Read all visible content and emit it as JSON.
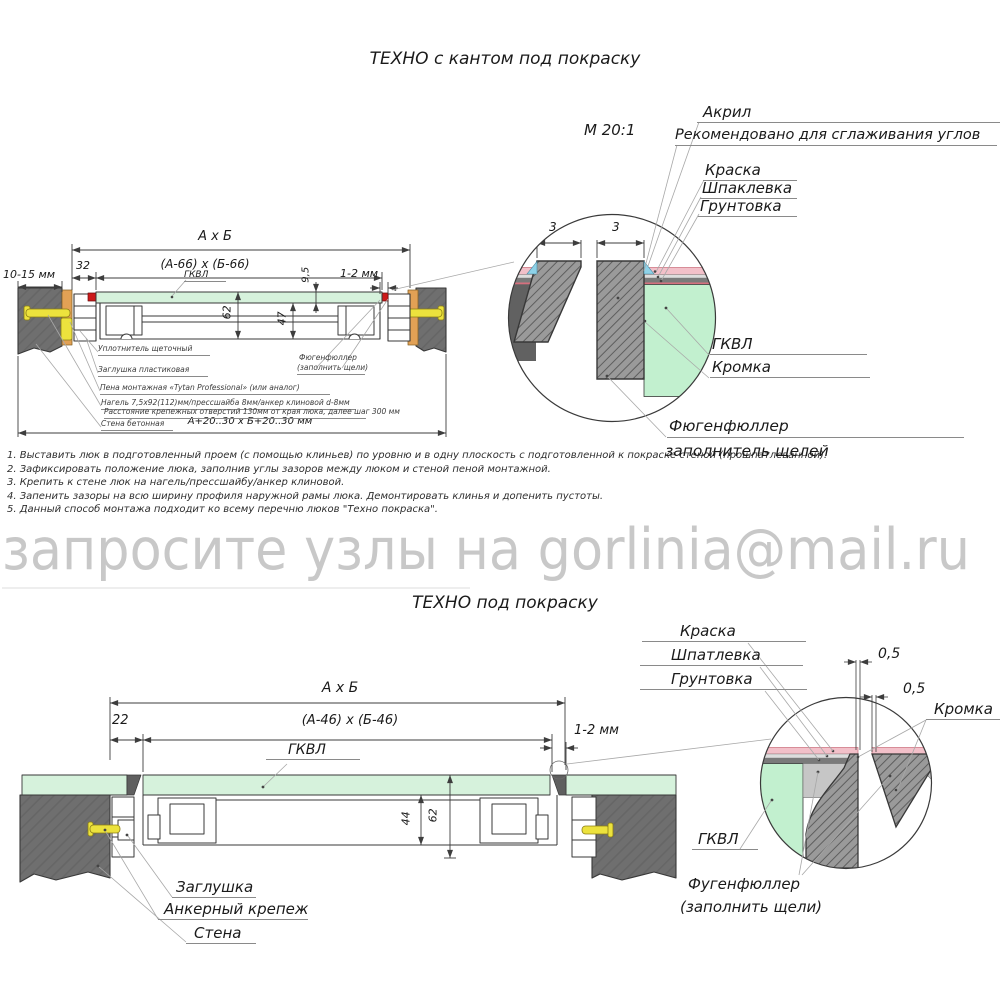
{
  "colors": {
    "wall_gray": "#6f6f6f",
    "panel_green": "#d6f2dc",
    "detail_green": "#c2f0cf",
    "wedge_orange": "#e2a155",
    "anchor_yellow": "#ece23d",
    "marker_red": "#cc1a1a",
    "paint_pink": "#f2c0c9",
    "acrylic_blue": "#8ed2e8",
    "filler_gray": "#c6c6c6",
    "watermark_gray": "#c8c8c8"
  },
  "watermark": {
    "text": "запросите узлы на gorlinia@mail.ru"
  },
  "top": {
    "title": "ТЕХНО с кантом под покраску",
    "scale": "М 20:1",
    "dims": {
      "axb": "А х Б",
      "inner": "(А-66) х (Б-66)",
      "d32": "32",
      "d1015": "10-15 мм",
      "d95": "9,5",
      "d12": "1-2 мм",
      "d62": "62",
      "d47": "47",
      "opening": "А+20..30 х Б+20..30 мм",
      "d3l": "3",
      "d3r": "3"
    },
    "labels": {
      "gkvl_panel": "ГКВЛ",
      "acryl": "Акрил",
      "acryl_note": "Рекомендовано для сглаживания углов",
      "paint": "Краска",
      "putty": "Шпаклевка",
      "primer": "Грунтовка",
      "gkvl": "ГКВЛ",
      "edge": "Кромка",
      "filler_1": "Фюгенфюллер",
      "filler_2": "заполнитель щелей"
    },
    "callouts": {
      "seal": "Уплотнитель щеточный",
      "plug": "Заглушка пластиковая",
      "foam": "Пена монтажная «Tytan Professional» (или аналог)",
      "nagel": "Нагель 7,5х92(112)мм/прессшайба 8мм/анкер клиновой d-8мм",
      "spacing": "Расстояние крепежных отверстий 130мм от края люка, далее шаг 300 мм",
      "wall": "Стена бетонная",
      "filler_1": "Фюгенфюллер",
      "filler_2": "(заполнить щели)"
    },
    "notes": [
      "1. Выставить люк в подготовленный проем (с помощью клиньев) по уровню и в одну плоскость с подготовленной к покраске стеной (прошпатлеванной).",
      "2. Зафиксировать положение люка, заполнив углы зазоров между люком и стеной пеной монтажной.",
      "3. Крепить к стене люк на нагель/прессшайбу/анкер клиновой.",
      "4. Запенить зазоры на всю ширину профиля наружной рамы люка. Демонтировать клинья и допенить пустоты.",
      "5. Данный способ монтажа подходит ко всему перечню люков \"Техно покраска\"."
    ]
  },
  "bottom": {
    "title": "ТЕХНО под покраску",
    "dims": {
      "axb": "А х Б",
      "inner": "(А-46) х (Б-46)",
      "d22": "22",
      "d12": "1-2 мм",
      "d44": "44",
      "d62": "62",
      "d05a": "0,5",
      "d05b": "0,5"
    },
    "labels": {
      "gkvl_panel": "ГКВЛ",
      "paint": "Краска",
      "putty": "Шпатлевка",
      "primer": "Грунтовка",
      "edge": "Кромка",
      "gkvl": "ГКВЛ",
      "filler_1": "Фугенфюллер",
      "filler_2": "(заполнить щели)",
      "plug": "Заглушка",
      "anchor": "Анкерный крепеж",
      "wall": "Стена"
    }
  }
}
